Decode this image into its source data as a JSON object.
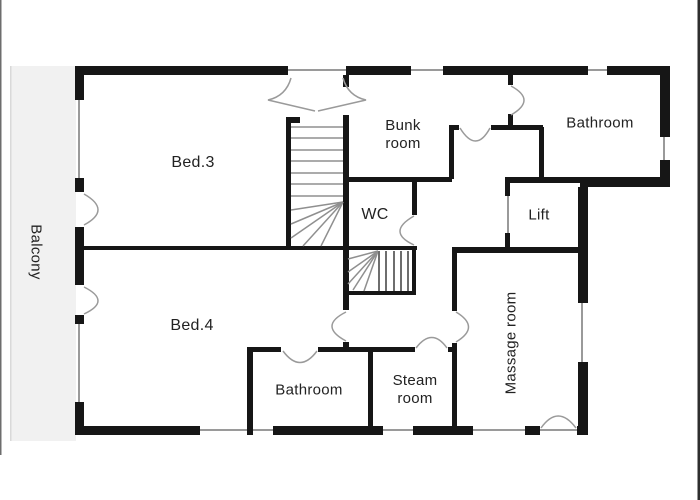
{
  "plan": {
    "labels": {
      "balcony": "Balcony",
      "bed3": "Bed.3",
      "bed4": "Bed.4",
      "bunk_room": "Bunk room",
      "wc": "WC",
      "bathroom_upper": "Bathroom",
      "lift": "Lift",
      "massage_room": "Massage room",
      "bathroom_lower": "Bathroom",
      "steam_room": "Steam room"
    },
    "colors": {
      "wall": "#161616",
      "balcony_fill": "#f1f1f1",
      "window_line": "#9a9a9a",
      "door_arc": "#9a9a9a",
      "stair_line": "#8f8f8f",
      "label_text": "#222222",
      "background": "#ffffff"
    }
  }
}
